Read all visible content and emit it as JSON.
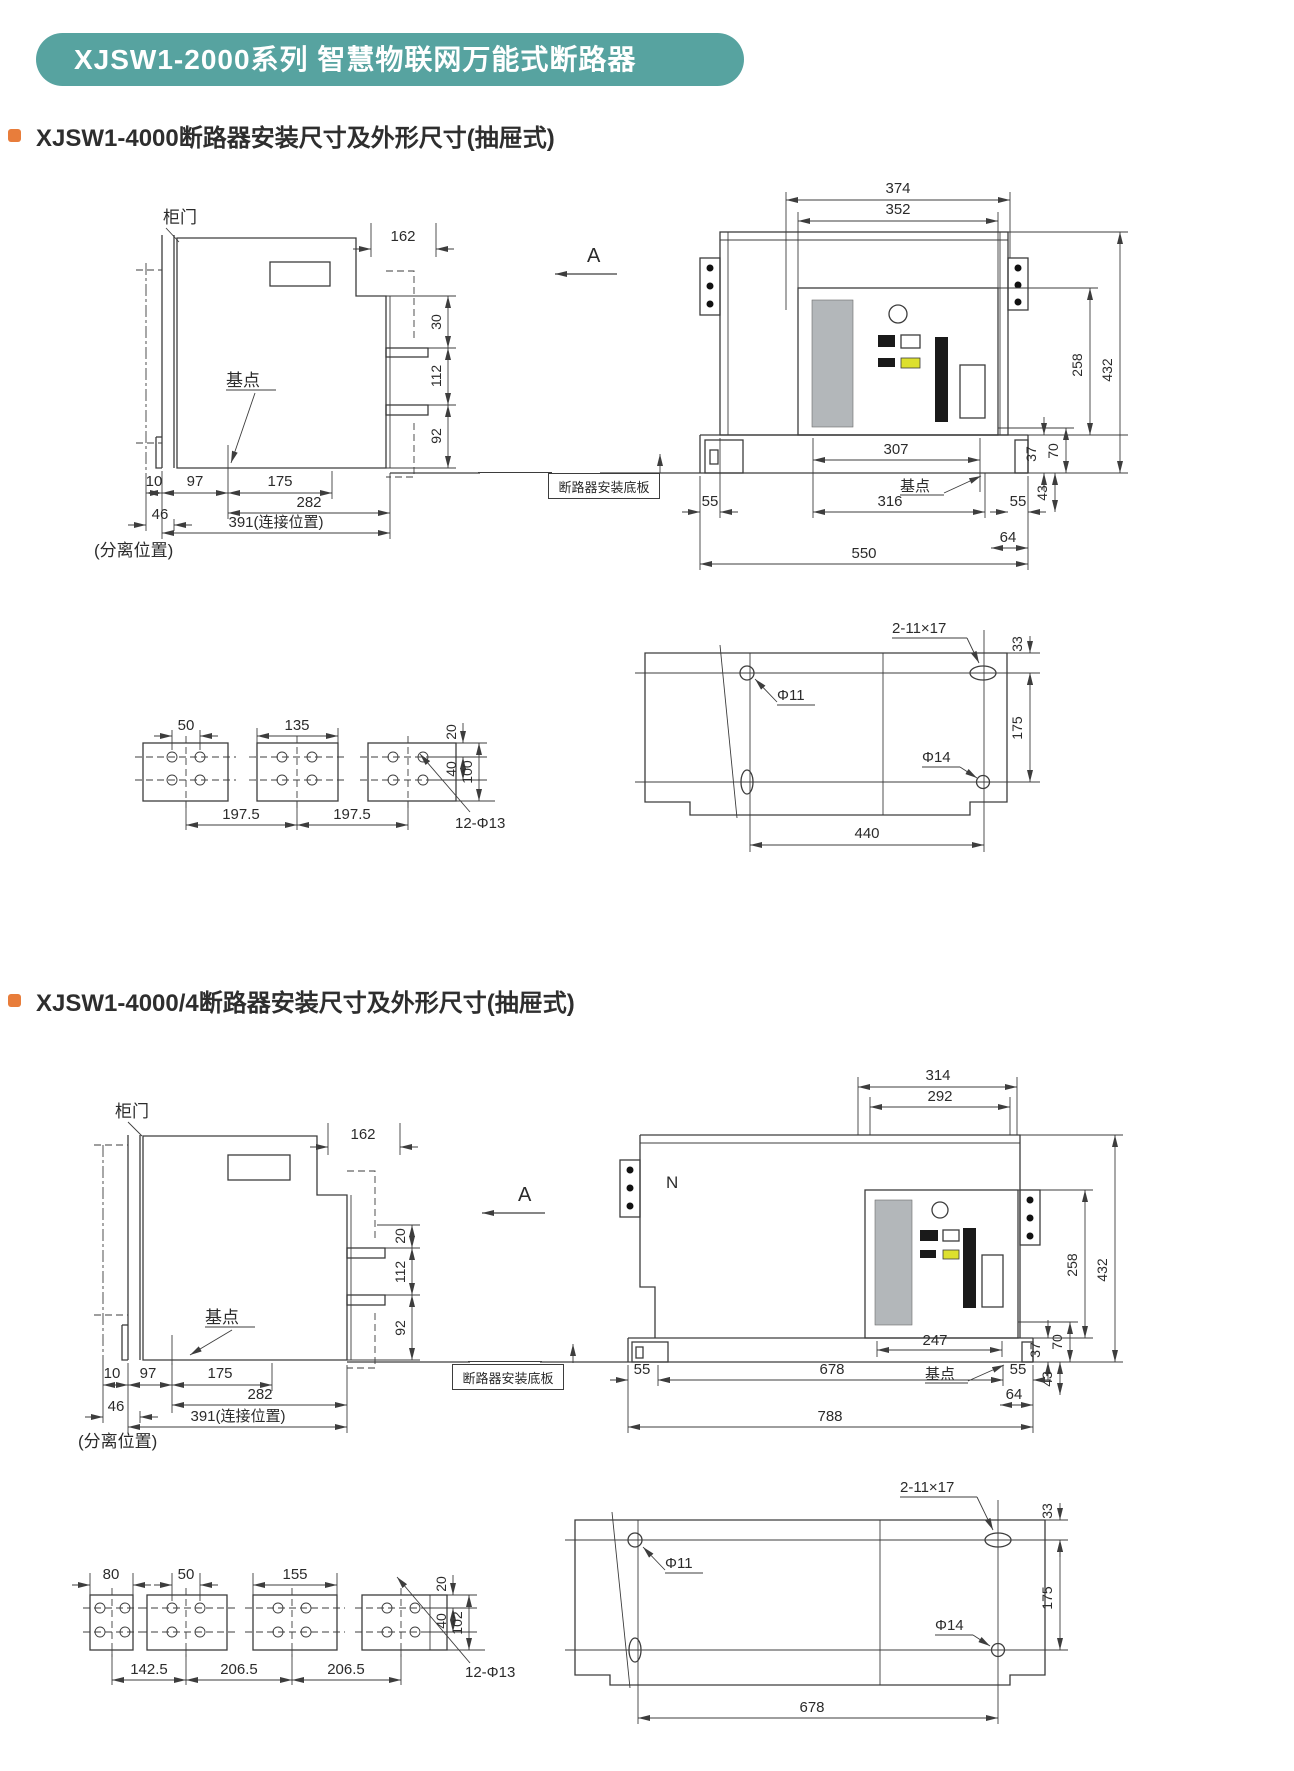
{
  "banner": {
    "title": "XJSW1-2000系列 智慧物联网万能式断路器",
    "bg": "#57a3a0"
  },
  "sections": {
    "s1": {
      "heading": "XJSW1-4000断路器安装尺寸及外形尺寸(抽屉式)"
    },
    "s2": {
      "heading": "XJSW1-4000/4断路器安装尺寸及外形尺寸(抽屉式)"
    }
  },
  "labels": {
    "cabinet_door": "柜门",
    "base_point": "基点",
    "view_a": "A",
    "mount_plate": "断路器安装底板",
    "separated_pos": "(分离位置)",
    "connect_391": "391(连接位置)",
    "neutral": "N",
    "slot_2_11x17": "2-11×17",
    "phi11": "Φ11",
    "phi14": "Φ14",
    "holes_12_phi13": "12-Φ13"
  },
  "dims": {
    "d10": "10",
    "d20": "20",
    "d30": "30",
    "d33": "33",
    "d37": "37",
    "d40": "40",
    "d43": "43",
    "d46": "46",
    "d50": "50",
    "d55": "55",
    "d64": "64",
    "d70": "70",
    "d80": "80",
    "d92": "92",
    "d97": "97",
    "d100": "100",
    "d102": "102",
    "d112": "112",
    "d135": "135",
    "d142_5": "142.5",
    "d155": "155",
    "d162": "162",
    "d175": "175",
    "d197_5": "197.5",
    "d206_5": "206.5",
    "d247": "247",
    "d258": "258",
    "d282": "282",
    "d292": "292",
    "d307": "307",
    "d314": "314",
    "d316": "316",
    "d352": "352",
    "d374": "374",
    "d432": "432",
    "d440": "440",
    "d550": "550",
    "d678": "678",
    "d788": "788"
  },
  "colors": {
    "line": "#3d3d3d",
    "panel_gray": "#b3b7ba",
    "indicator_yellow": "#dde02e",
    "bullet": "#e87d3b"
  }
}
